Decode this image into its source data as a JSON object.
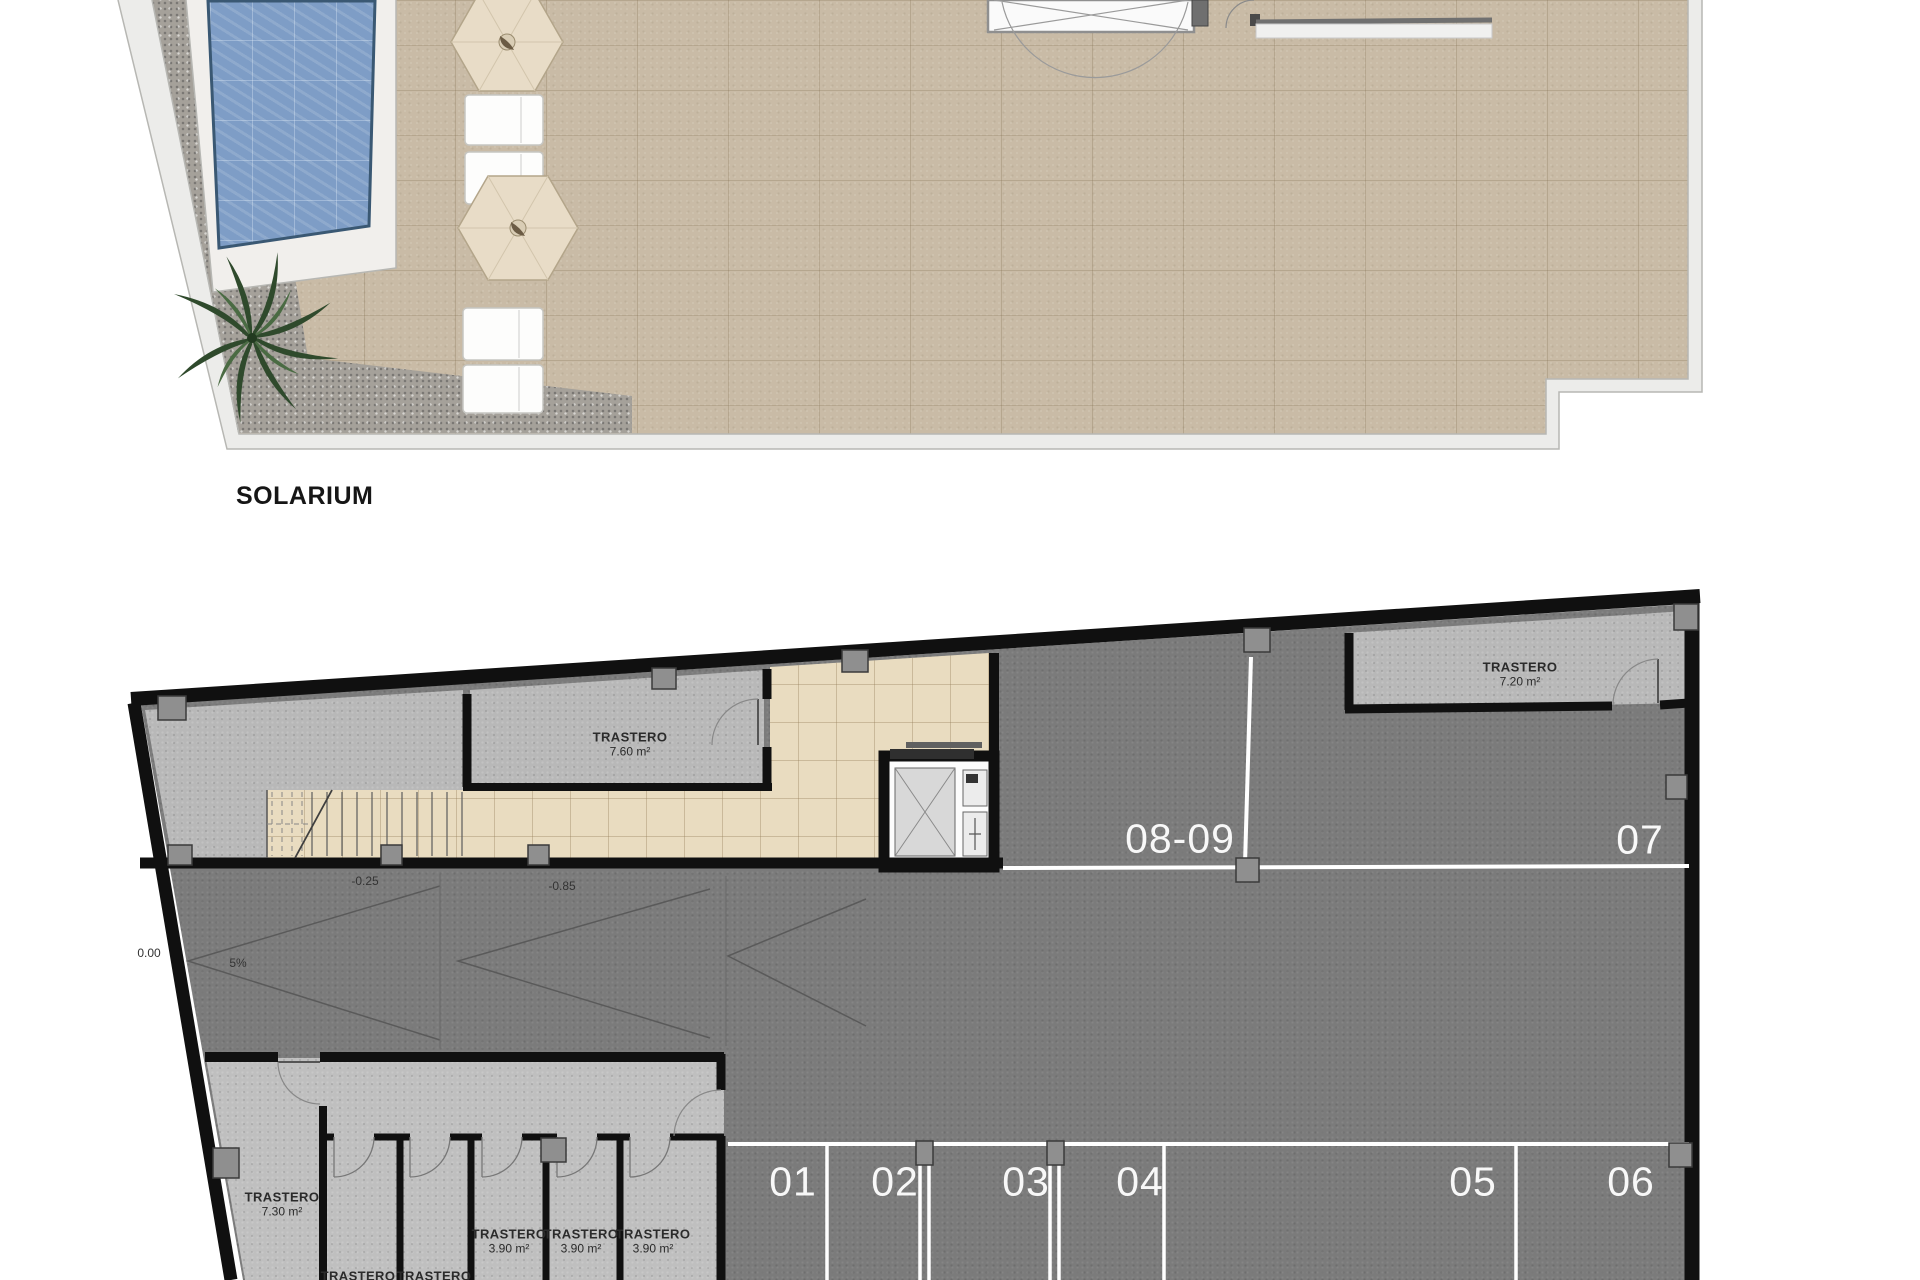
{
  "colors": {
    "pool_blue": "#7e9dc6",
    "terrace_beige": "#c9bba6",
    "asphalt_gray": "#7b7b7b",
    "room_gray": "#b8b8b8",
    "tile_beige": "#e9dcc0",
    "wall_black": "#101010",
    "marking_white": "#ffffff"
  },
  "solarium": {
    "title": "SOLARIUM"
  },
  "basement": {
    "levels": {
      "ground": "0.00",
      "ramp_upper": "-0.25",
      "ramp_lower": "-0.85",
      "slope": "5%"
    },
    "storerooms": {
      "s760": {
        "name": "TRASTERO",
        "area": "7.60 m²"
      },
      "s720": {
        "name": "TRASTERO",
        "area": "7.20 m²"
      },
      "s730": {
        "name": "TRASTERO",
        "area": "7.30 m²"
      },
      "s390_1": {
        "name": "TRASTERO",
        "area": "3.90 m²"
      },
      "s390_2": {
        "name": "TRASTERO",
        "area": "3.90 m²"
      },
      "s390_3": {
        "name": "TRASTERO",
        "area": "3.90 m²"
      },
      "s_small_1": {
        "name": "TRASTERO"
      },
      "s_small_2": {
        "name": "TRASTERO"
      }
    },
    "parking": {
      "stalls": [
        "01",
        "02",
        "03",
        "04",
        "05",
        "06"
      ],
      "stall_07": "07",
      "stall_08_09": "08-09"
    }
  }
}
